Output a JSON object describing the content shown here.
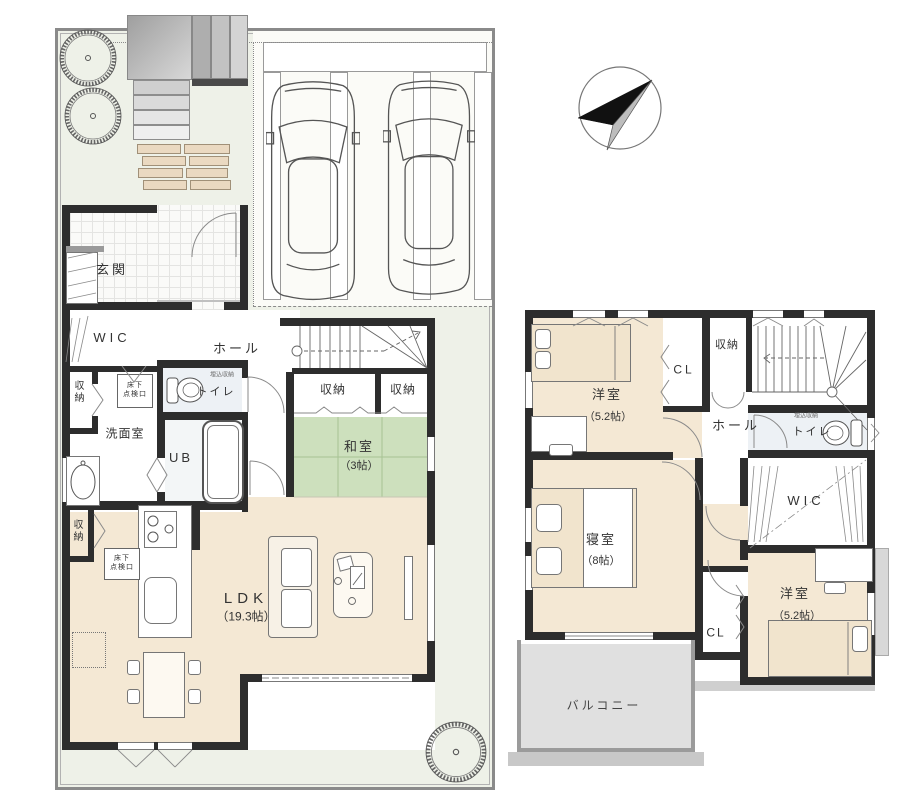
{
  "floor1": {
    "entrance": "玄関",
    "wic": "WIC",
    "storage_a": "収納",
    "storage_b": "収納",
    "hall": "ホール",
    "toilet": "トイレ",
    "toilet_note": "埋込収納",
    "washroom": "洗面室",
    "bath": "UB",
    "hatch_line1": "床下",
    "hatch_line2": "点検口",
    "tatami_room": "和室",
    "tatami_size": "（3帖）",
    "storage_c": "収納",
    "storage_d": "収納",
    "ldk": "LDK",
    "ldk_size": "（19.3帖）"
  },
  "floor2": {
    "bedroom1": "洋室",
    "bedroom1_size": "（5.2帖）",
    "closet1": "CL",
    "storage": "収納",
    "hall": "ホール",
    "toilet": "トイレ",
    "toilet_note": "埋込収納",
    "wic": "WIC",
    "master": "寝室",
    "master_size": "（8帖）",
    "closet2": "CL",
    "bedroom2": "洋室",
    "bedroom2_size": "（5.2帖）",
    "balcony": "バルコニー"
  },
  "icons": {
    "compass": "north-arrow",
    "trees": "garden-tree",
    "cars": "parked-car"
  },
  "colors": {
    "wall": "#2d2d2d",
    "room_floor": "#f4e8d4",
    "tatami": "#cde0bd",
    "site": "#eef1e8",
    "balcony": "#e0e0e0",
    "plank": "#ead9c1"
  }
}
